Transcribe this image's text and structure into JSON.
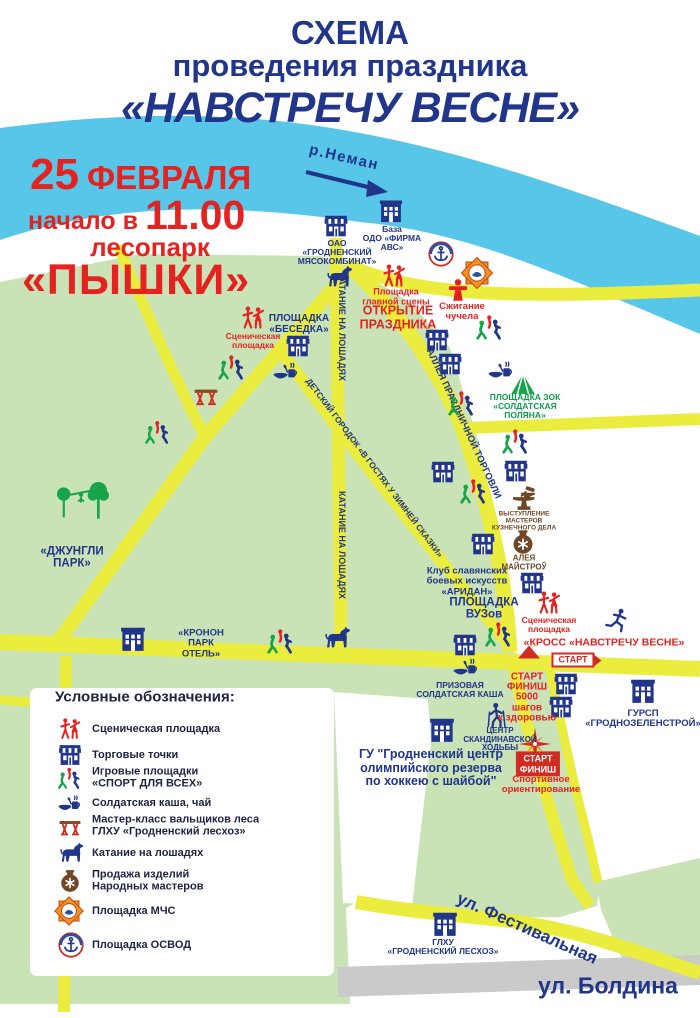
{
  "title": {
    "line1": "СХЕМА",
    "line2": "проведения праздника",
    "line3": "«НАВСТРЕЧУ ВЕСНЕ»"
  },
  "event": {
    "day": "25",
    "month": "ФЕВРАЛЯ",
    "time_label": "начало в",
    "time": "11.00",
    "park_word": "лесопарк",
    "park_name": "«ПЫШКИ»"
  },
  "river": {
    "label": "р.Неман"
  },
  "roads_labels": {
    "alley": "АЛЛЕЯ ПРАЗДНИЧНОЙ ТОРГОВЛИ",
    "kids": "ДЕТСКИЙ ГОРОДОК «В ГОСТЯХ У ЗИМНЕЙ СКАЗКИ»",
    "horse1": "КАТАНИЕ НА ЛОШАДЯХ",
    "horse2": "КАТАНИЕ НА ЛОШАДЯХ",
    "festival": "ул. Фестивальная",
    "boldina": "ул. Болдина"
  },
  "locations": {
    "meat_plant": "ОАО\n«ГРОДНЕНСКИЙ\nМЯСОКОМБИНАТ»",
    "base_abc": "База\nОДО «ФИРМА\nАВС»",
    "besedka": "ПЛОЩАДКА\n«БЕСЕДКА»",
    "stage_small_1": "Сценическая\nплощадка",
    "main_stage": "Площадка\nглавной сцены",
    "opening": "ОТКРЫТИЕ\nПРАЗДНИКА",
    "effigy": "Сжигание\nчучела",
    "soldier_glade": "ПЛОЩАДКА ЗОК\n«СОЛДАТСКАЯ\nПОЛЯНА»",
    "jungle": "«ДЖУНГЛИ\nПАРК»",
    "blacksmith": "ВЫСТУПЛЕНИЕ\nМАСТЕРОВ\nКУЗНЕЧНОГО ДЕЛА",
    "masters_alley": "АЛЕЯ\nМАЙСТРОЎ",
    "aridan": "Клуб славянских\nбоевых искусств\n«АРИДАН»",
    "vuz": "ПЛОЩАДКА\nВУЗов",
    "kronon": "«КРОНОН\nПАРК\nОТЕЛЬ»",
    "cross": "«КРОСС «НАВСТРЕЧУ ВЕСНЕ»",
    "stage_small_2": "Сценическая\nплощадка",
    "start_sign": "СТАРТ",
    "start_finish_5000": "СТАРТ\nФИНИШ\n5000\nшагов\nк здоровью",
    "prize_kasha": "ПРИЗОВАЯ\nСОЛДАТСКАЯ КАША",
    "nordic_center": "ЦЕНТР\nСКАНДИНАВСКОЙ\nХОДЬБЫ",
    "olympic": "ГУ \"Гродненский центр\nолимпийского резерва\nпо хоккею с шайбой\"",
    "gursp": "ГУРСП\n«ГРОДНОЗЕЛЕНСТРОЙ»",
    "orienteering_start": "СТАРТ\nФИНИШ",
    "orienteering": "Спортивное\nориентирование",
    "leshoz": "ГЛХУ\n«ГРОДНЕНСКИЙ ЛЕСХОЗ»"
  },
  "legend": {
    "heading": "Условные обозначения:",
    "items": [
      {
        "icon": "stage-icon",
        "label": "Сценическая площадка"
      },
      {
        "icon": "shop-icon",
        "label": "Торговые точки"
      },
      {
        "icon": "sport-icon",
        "label": "Игровые площадки\n«СПОРТ ДЛЯ ВСЕХ»"
      },
      {
        "icon": "food-icon",
        "label": "Солдатская каша, чай"
      },
      {
        "icon": "table-icon",
        "label": "Мастер-класс вальщиков леса\nГЛХУ «Гродненский лесхоз»"
      },
      {
        "icon": "horse-icon",
        "label": "Катание на лошадях"
      },
      {
        "icon": "pot-icon",
        "label": "Продажа изделий\nНародных мастеров"
      },
      {
        "icon": "mchs-icon",
        "label": "Площадка МЧС"
      },
      {
        "icon": "osvod-icon",
        "label": "Площадка ОСВОД"
      }
    ]
  },
  "colors": {
    "title_blue": "#21368b",
    "accent_red": "#e42320",
    "river_blue": "#57c6e9",
    "park_green": "#c9e2b6",
    "road_yellow": "#ebed3e",
    "legend_green": "#0e9e4c",
    "brown": "#6e4826",
    "gray_road": "#cacaca"
  }
}
